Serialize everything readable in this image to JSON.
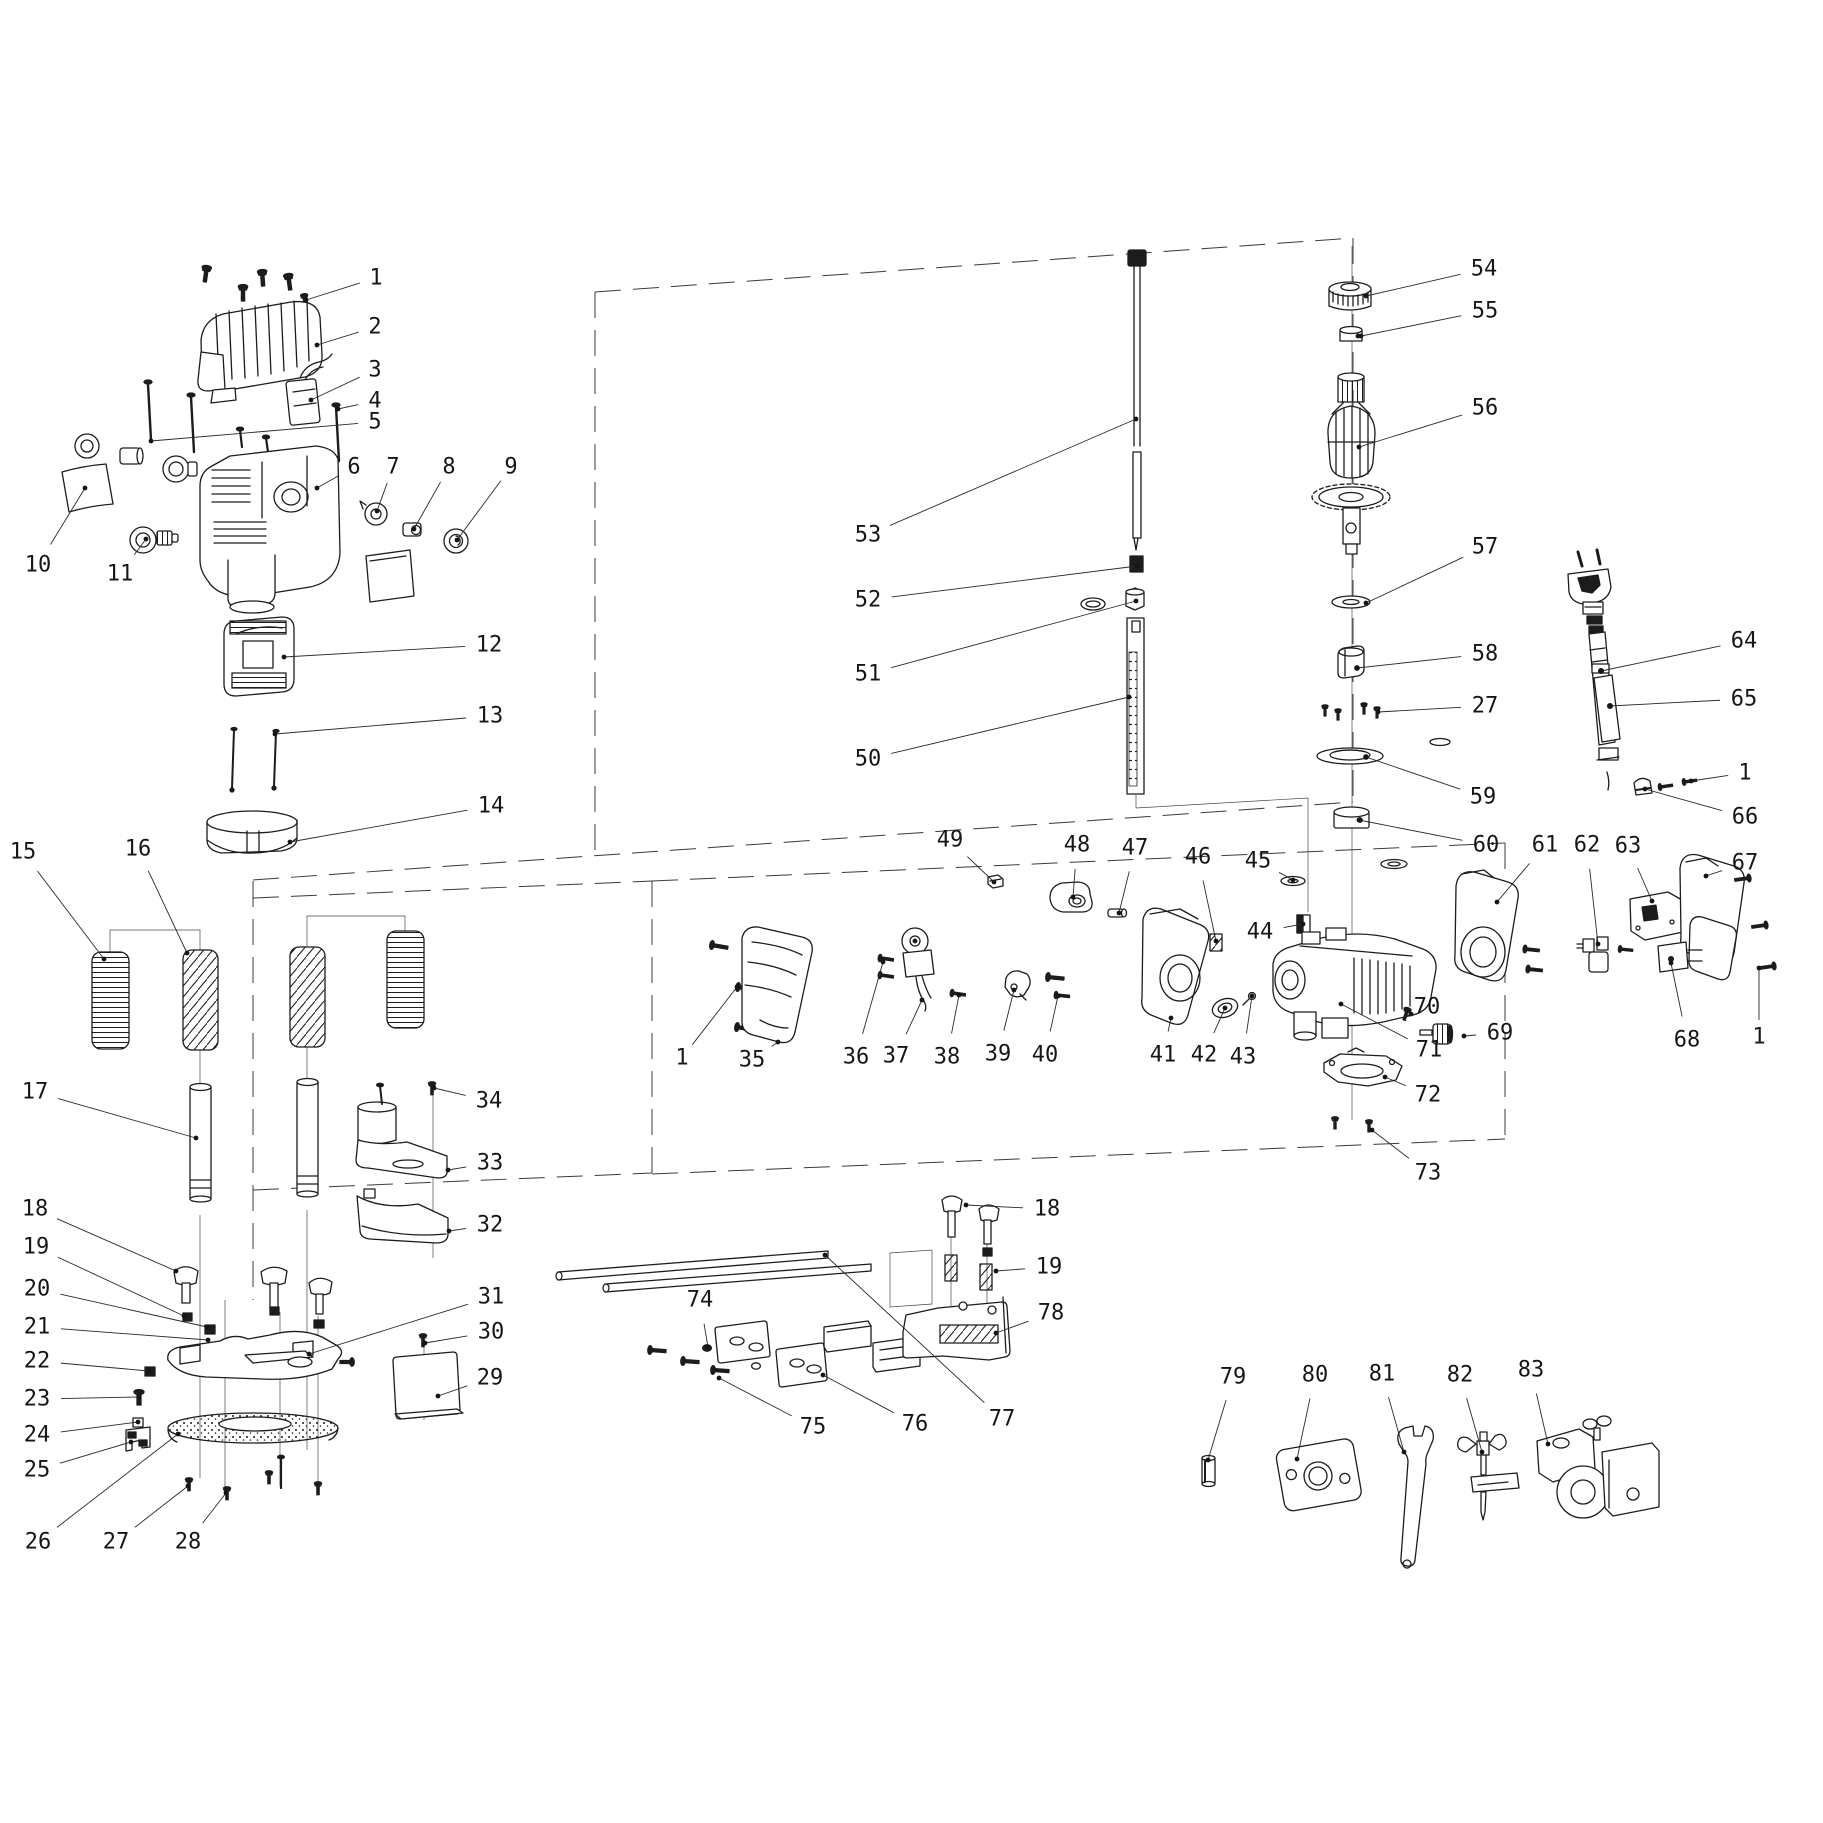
{
  "diagram": {
    "background": "#ffffff",
    "ink": "#1c1c1c",
    "font_size": 22,
    "leader_dot_radius": 2.4,
    "callouts": [
      {
        "n": "1",
        "x": 376,
        "y": 278,
        "tx": 306,
        "ty": 300
      },
      {
        "n": "2",
        "x": 375,
        "y": 327,
        "tx": 317,
        "ty": 345
      },
      {
        "n": "3",
        "x": 375,
        "y": 370,
        "tx": 311,
        "ty": 400
      },
      {
        "n": "4",
        "x": 375,
        "y": 401,
        "tx": 338,
        "ty": 409
      },
      {
        "n": "5",
        "x": 375,
        "y": 422,
        "tx": 151,
        "ty": 441
      },
      {
        "n": "6",
        "x": 354,
        "y": 467,
        "tx": 317,
        "ty": 488
      },
      {
        "n": "7",
        "x": 393,
        "y": 467,
        "tx": 377,
        "ty": 511
      },
      {
        "n": "8",
        "x": 449,
        "y": 467,
        "tx": 414,
        "ty": 529
      },
      {
        "n": "9",
        "x": 511,
        "y": 467,
        "tx": 457,
        "ty": 540
      },
      {
        "n": "10",
        "x": 38,
        "y": 565,
        "tx": 85,
        "ty": 488
      },
      {
        "n": "11",
        "x": 120,
        "y": 574,
        "tx": 146,
        "ty": 539
      },
      {
        "n": "12",
        "x": 489,
        "y": 645,
        "tx": 284,
        "ty": 657
      },
      {
        "n": "13",
        "x": 490,
        "y": 716,
        "tx": 275,
        "ty": 734
      },
      {
        "n": "14",
        "x": 491,
        "y": 806,
        "tx": 290,
        "ty": 842
      },
      {
        "n": "15",
        "x": 23,
        "y": 852,
        "tx": 104,
        "ty": 959
      },
      {
        "n": "16",
        "x": 138,
        "y": 849,
        "tx": 187,
        "ty": 953
      },
      {
        "n": "17",
        "x": 35,
        "y": 1092,
        "tx": 196,
        "ty": 1138
      },
      {
        "n": "18",
        "x": 35,
        "y": 1209,
        "tx": 176,
        "ty": 1271
      },
      {
        "n": "19",
        "x": 36,
        "y": 1247,
        "tx": 184,
        "ty": 1316
      },
      {
        "n": "20",
        "x": 37,
        "y": 1289,
        "tx": 207,
        "ty": 1327
      },
      {
        "n": "21",
        "x": 37,
        "y": 1327,
        "tx": 208,
        "ty": 1340
      },
      {
        "n": "22",
        "x": 37,
        "y": 1361,
        "tx": 149,
        "ty": 1371
      },
      {
        "n": "23",
        "x": 37,
        "y": 1399,
        "tx": 139,
        "ty": 1397
      },
      {
        "n": "24",
        "x": 37,
        "y": 1435,
        "tx": 138,
        "ty": 1422
      },
      {
        "n": "25",
        "x": 37,
        "y": 1470,
        "tx": 131,
        "ty": 1442
      },
      {
        "n": "26",
        "x": 38,
        "y": 1542,
        "tx": 178,
        "ty": 1434
      },
      {
        "n": "27",
        "x": 116,
        "y": 1542,
        "tx": 188,
        "ty": 1486
      },
      {
        "n": "28",
        "x": 188,
        "y": 1542,
        "tx": 226,
        "ty": 1493
      },
      {
        "n": "29",
        "x": 490,
        "y": 1378,
        "tx": 438,
        "ty": 1396
      },
      {
        "n": "30",
        "x": 491,
        "y": 1332,
        "tx": 425,
        "ty": 1343
      },
      {
        "n": "31",
        "x": 491,
        "y": 1297,
        "tx": 309,
        "ty": 1354
      },
      {
        "n": "32",
        "x": 490,
        "y": 1225,
        "tx": 449,
        "ty": 1231
      },
      {
        "n": "33",
        "x": 490,
        "y": 1163,
        "tx": 448,
        "ty": 1170
      },
      {
        "n": "34",
        "x": 489,
        "y": 1101,
        "tx": 434,
        "ty": 1088
      },
      {
        "n": "35",
        "x": 752,
        "y": 1060,
        "tx": 778,
        "ty": 1042
      },
      {
        "n": "36",
        "x": 856,
        "y": 1057,
        "tx": 883,
        "ty": 962
      },
      {
        "n": "37",
        "x": 896,
        "y": 1056,
        "tx": 922,
        "ty": 1000
      },
      {
        "n": "38",
        "x": 947,
        "y": 1057,
        "tx": 959,
        "ty": 995
      },
      {
        "n": "39",
        "x": 998,
        "y": 1054,
        "tx": 1014,
        "ty": 990
      },
      {
        "n": "40",
        "x": 1045,
        "y": 1055,
        "tx": 1058,
        "ty": 996
      },
      {
        "n": "41",
        "x": 1163,
        "y": 1055,
        "tx": 1171,
        "ty": 1018
      },
      {
        "n": "42",
        "x": 1204,
        "y": 1055,
        "tx": 1225,
        "ty": 1008
      },
      {
        "n": "43",
        "x": 1243,
        "y": 1057,
        "tx": 1252,
        "ty": 996
      },
      {
        "n": "44",
        "x": 1260,
        "y": 932,
        "tx": 1303,
        "ty": 924
      },
      {
        "n": "45",
        "x": 1258,
        "y": 861,
        "tx": 1293,
        "ty": 880
      },
      {
        "n": "46",
        "x": 1198,
        "y": 857,
        "tx": 1216,
        "ty": 941
      },
      {
        "n": "47",
        "x": 1135,
        "y": 848,
        "tx": 1119,
        "ty": 913
      },
      {
        "n": "48",
        "x": 1077,
        "y": 845,
        "tx": 1073,
        "ty": 897
      },
      {
        "n": "49",
        "x": 950,
        "y": 840,
        "tx": 994,
        "ty": 882
      },
      {
        "n": "50",
        "x": 868,
        "y": 759,
        "tx": 1129,
        "ty": 697
      },
      {
        "n": "51",
        "x": 868,
        "y": 674,
        "tx": 1136,
        "ty": 601
      },
      {
        "n": "52",
        "x": 868,
        "y": 600,
        "tx": 1137,
        "ty": 566
      },
      {
        "n": "53",
        "x": 868,
        "y": 535,
        "tx": 1136,
        "ty": 419
      },
      {
        "n": "54",
        "x": 1484,
        "y": 269,
        "tx": 1366,
        "ty": 296
      },
      {
        "n": "55",
        "x": 1485,
        "y": 311,
        "tx": 1361,
        "ty": 336
      },
      {
        "n": "56",
        "x": 1485,
        "y": 408,
        "tx": 1359,
        "ty": 447
      },
      {
        "n": "57",
        "x": 1485,
        "y": 547,
        "tx": 1366,
        "ty": 603
      },
      {
        "n": "58",
        "x": 1485,
        "y": 654,
        "tx": 1357,
        "ty": 668
      },
      {
        "n": "27",
        "x": 1485,
        "y": 706,
        "tx": 1378,
        "ty": 712
      },
      {
        "n": "59",
        "x": 1483,
        "y": 797,
        "tx": 1366,
        "ty": 757
      },
      {
        "n": "60",
        "x": 1486,
        "y": 845,
        "tx": 1359,
        "ty": 820
      },
      {
        "n": "61",
        "x": 1545,
        "y": 845,
        "tx": 1497,
        "ty": 902
      },
      {
        "n": "62",
        "x": 1587,
        "y": 845,
        "tx": 1598,
        "ty": 944
      },
      {
        "n": "63",
        "x": 1628,
        "y": 846,
        "tx": 1652,
        "ty": 901
      },
      {
        "n": "64",
        "x": 1744,
        "y": 641,
        "tx": 1601,
        "ty": 671
      },
      {
        "n": "65",
        "x": 1744,
        "y": 699,
        "tx": 1610,
        "ty": 706
      },
      {
        "n": "1",
        "x": 1745,
        "y": 773,
        "tx": 1691,
        "ty": 781
      },
      {
        "n": "66",
        "x": 1745,
        "y": 817,
        "tx": 1645,
        "ty": 789
      },
      {
        "n": "67",
        "x": 1745,
        "y": 863,
        "tx": 1706,
        "ty": 876
      },
      {
        "n": "68",
        "x": 1687,
        "y": 1040,
        "tx": 1671,
        "ty": 963
      },
      {
        "n": "69",
        "x": 1500,
        "y": 1033,
        "tx": 1464,
        "ty": 1036
      },
      {
        "n": "70",
        "x": 1427,
        "y": 1007,
        "tx": 1411,
        "ty": 1014
      },
      {
        "n": "71",
        "x": 1429,
        "y": 1050,
        "tx": 1341,
        "ty": 1004
      },
      {
        "n": "72",
        "x": 1428,
        "y": 1095,
        "tx": 1385,
        "ty": 1077
      },
      {
        "n": "73",
        "x": 1428,
        "y": 1173,
        "tx": 1372,
        "ty": 1130
      },
      {
        "n": "1",
        "x": 682,
        "y": 1058,
        "tx": 737,
        "ty": 987
      },
      {
        "n": "1",
        "x": 1759,
        "y": 1037,
        "tx": 1759,
        "ty": 968
      },
      {
        "n": "74",
        "x": 700,
        "y": 1300,
        "tx": 708,
        "ty": 1347
      },
      {
        "n": "75",
        "x": 813,
        "y": 1427,
        "tx": 719,
        "ty": 1378
      },
      {
        "n": "76",
        "x": 915,
        "y": 1424,
        "tx": 823,
        "ty": 1375
      },
      {
        "n": "77",
        "x": 1002,
        "y": 1419,
        "tx": 825,
        "ty": 1255
      },
      {
        "n": "78",
        "x": 1051,
        "y": 1313,
        "tx": 996,
        "ty": 1333
      },
      {
        "n": "18",
        "x": 1047,
        "y": 1209,
        "tx": 966,
        "ty": 1205
      },
      {
        "n": "19",
        "x": 1049,
        "y": 1267,
        "tx": 996,
        "ty": 1271
      },
      {
        "n": "79",
        "x": 1233,
        "y": 1377,
        "tx": 1208,
        "ty": 1460
      },
      {
        "n": "80",
        "x": 1315,
        "y": 1375,
        "tx": 1297,
        "ty": 1459
      },
      {
        "n": "81",
        "x": 1382,
        "y": 1374,
        "tx": 1404,
        "ty": 1452
      },
      {
        "n": "82",
        "x": 1460,
        "y": 1375,
        "tx": 1482,
        "ty": 1452
      },
      {
        "n": "83",
        "x": 1531,
        "y": 1370,
        "tx": 1548,
        "ty": 1444
      }
    ]
  }
}
